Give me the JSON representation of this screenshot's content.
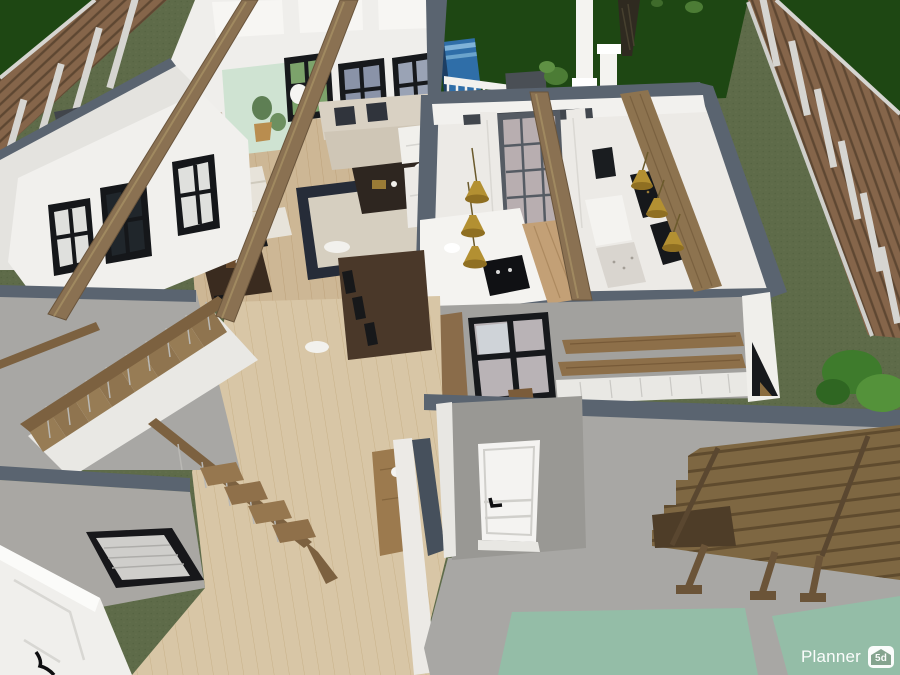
{
  "watermark": {
    "brand": "Planner",
    "badge": "5d"
  },
  "scene": {
    "kind": "3d-home-render",
    "areas": [
      "back-yard",
      "left-fence",
      "right-fence",
      "back-porch",
      "pool",
      "living-room",
      "fireplace",
      "home-office",
      "dining-area",
      "kitchen",
      "kitchen-island",
      "pendant-lights",
      "bar-counter",
      "mudroom",
      "hallway",
      "staircase",
      "entry-wall",
      "front-door",
      "patio",
      "pergola",
      "outdoor-rugs",
      "bush",
      "tree"
    ]
  },
  "palette": {
    "grass_olive": "#5e6b49",
    "grass_dark": "#1e4713",
    "fence_wood": "#85654a",
    "fence_post": "#d6d5d1",
    "wall_white": "#f1f0ed",
    "wall_cap_slate": "#5a6470",
    "floor_wood": "#cdb795",
    "floor_hall": "#d8c6a6",
    "beam_wood": "#8a7152",
    "concrete": "#a8a7a4",
    "rug_sage": "#94bda7",
    "pendant_gold": "#b39032",
    "sofa_beige": "#d9d1c3",
    "table_dark": "#3a2b1f",
    "pergola_wood": "#7e6742",
    "window_dark": "#17191c",
    "mint_wall": "#cfe3d2",
    "pool_blue": "#2f6ea8"
  }
}
